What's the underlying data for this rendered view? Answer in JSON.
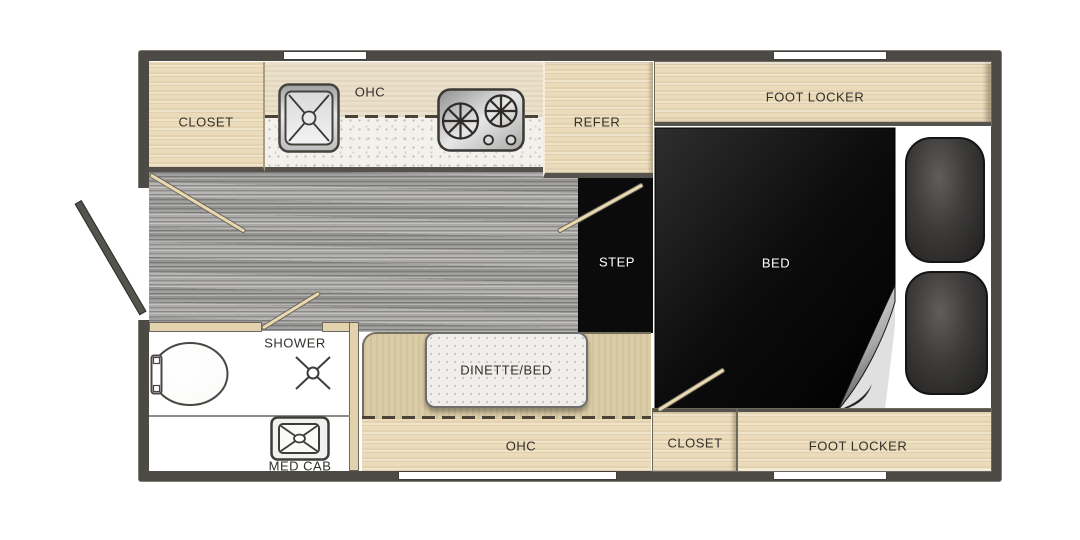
{
  "floorplan": {
    "labels": {
      "closet_top": "CLOSET",
      "ohc_top": "OHC",
      "refer": "REFER",
      "foot_locker_top": "FOOT LOCKER",
      "bed": "BED",
      "step": "STEP",
      "shower": "SHOWER",
      "med_cab": "MED CAB",
      "dinette_bed": "DINETTE/BED",
      "ohc_bottom": "OHC",
      "closet_bottom": "CLOSET",
      "foot_locker_bottom": "FOOT LOCKER"
    },
    "colors": {
      "wall": "#4d4a46",
      "wood": "#ebdbba",
      "band": "#e8dcc6",
      "bench": "#d8c8a1",
      "counter": "#f2f1ec",
      "floor": "#a09f9d",
      "bed": "#0b0b0b",
      "cushion": "#3c3b3a",
      "door_line": "#ead9b0",
      "label": "#33302a",
      "label_light": "#ffffff"
    }
  }
}
